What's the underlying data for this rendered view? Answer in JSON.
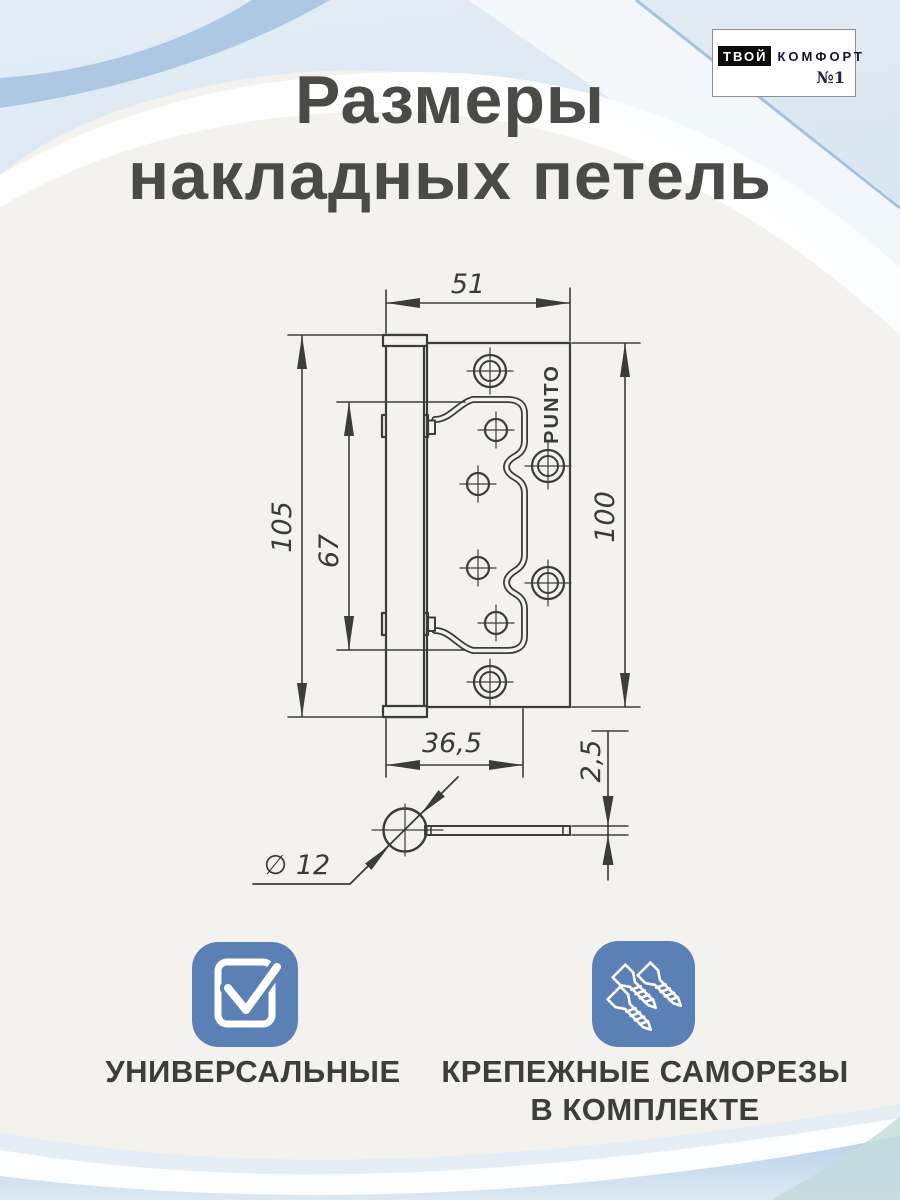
{
  "title": {
    "line1": "Размеры",
    "line2": "накладных петель"
  },
  "logo": {
    "word_black": "ТВОЙ",
    "word_rest": "КОМФОРТ",
    "number": "№1"
  },
  "drawing": {
    "brand": "PUNTO",
    "dims": {
      "width_total": "51",
      "height_total": "105",
      "inner_height": "67",
      "leaf_height": "100",
      "leaf_width": "36,5",
      "thickness": "2,5",
      "barrel_diameter": "∅ 12"
    }
  },
  "features": [
    {
      "label": "УНИВЕРСАЛЬНЫЕ"
    },
    {
      "label": "КРЕПЕЖНЫЕ САМОРЕЗЫ",
      "label2": "В КОМПЛЕКТЕ"
    }
  ],
  "colors": {
    "background": "#f4f2ee",
    "line": "#3c3c3a",
    "accent_tile_blue": "#5b80b5",
    "wave_blue": "#a9c6e2",
    "text_dark": "#4a4a47"
  }
}
